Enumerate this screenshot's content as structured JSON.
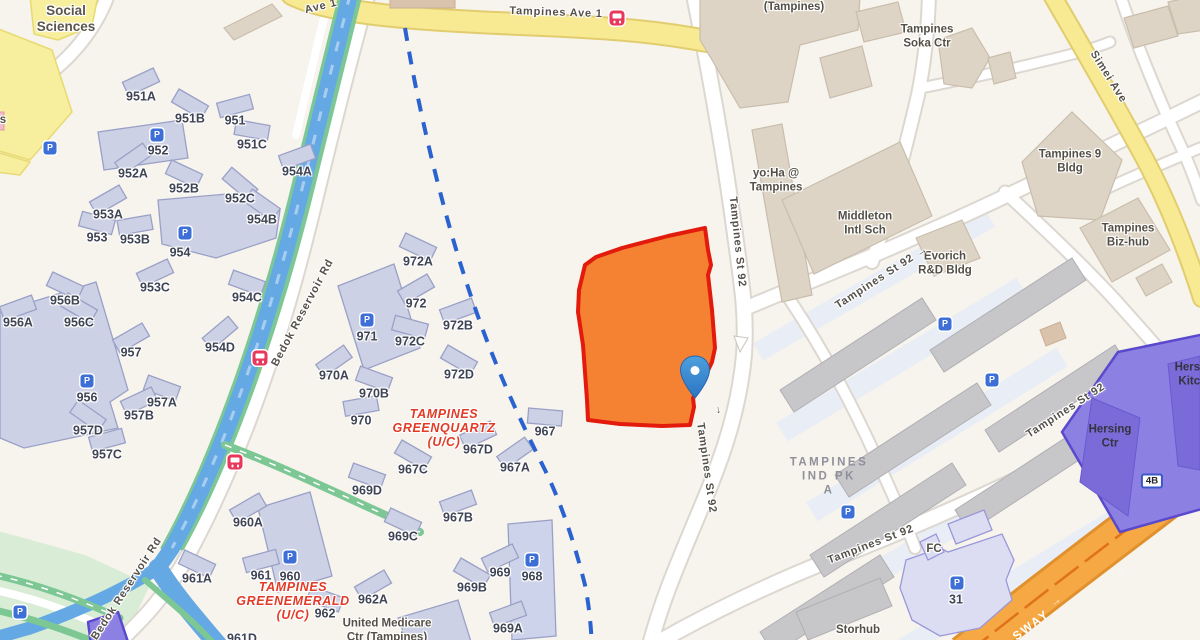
{
  "map": {
    "colors": {
      "land": "#f7f3ed",
      "parcel_fill": "#f47b28",
      "parcel_border": "#e21b0c",
      "pin_blue": "#3e8ecf",
      "canal_blue": "#64a9e4",
      "road_yellow": "#f8e993",
      "expressway_orange": "#f5a843",
      "purple_zone": "#8d80e3",
      "residential_building": "#cdd1e5",
      "boundary_dash_blue": "#2a63cf"
    },
    "labels": [
      {
        "t": "Social\nSciences",
        "x": 66,
        "y": 19,
        "c": "poilg"
      },
      {
        "t": "s",
        "x": 3,
        "y": 121,
        "c": "poi"
      },
      {
        "t": "Ave 1",
        "x": 321,
        "y": 7,
        "r": -14,
        "c": "road"
      },
      {
        "t": "Tampines Ave 1",
        "x": 556,
        "y": 13,
        "r": 2,
        "c": "road"
      },
      {
        "t": "(Tampines)",
        "x": 794,
        "y": 8,
        "c": "poi"
      },
      {
        "t": "Tampines\nSoka Ctr",
        "x": 927,
        "y": 37,
        "c": "poi"
      },
      {
        "t": "Simei Ave",
        "x": 1108,
        "y": 77,
        "r": 58,
        "c": "road"
      },
      {
        "t": "Tampines 9\nBldg",
        "x": 1070,
        "y": 162,
        "c": "poi"
      },
      {
        "t": "Tampines\nBiz-hub",
        "x": 1128,
        "y": 236,
        "c": "poi"
      },
      {
        "t": "yo:Ha @\nTampines",
        "x": 776,
        "y": 181,
        "c": "poi"
      },
      {
        "t": "Middleton\nIntl Sch",
        "x": 865,
        "y": 224,
        "c": "poi"
      },
      {
        "t": "Evorich\nR&D Bldg",
        "x": 945,
        "y": 264,
        "c": "poi"
      },
      {
        "t": "Tampines St 92",
        "x": 737,
        "y": 242,
        "r": 84,
        "c": "road"
      },
      {
        "t": "Tampines St 92",
        "x": 875,
        "y": 282,
        "r": -33,
        "c": "road"
      },
      {
        "t": "Tampines St 92",
        "x": 706,
        "y": 468,
        "r": 82,
        "c": "road"
      },
      {
        "t": "Tampines St 92",
        "x": 1066,
        "y": 411,
        "r": -33,
        "c": "road"
      },
      {
        "t": "Tampines St 92",
        "x": 871,
        "y": 545,
        "r": -21,
        "c": "road"
      },
      {
        "t": "Bedok Reservoir Rd",
        "x": 303,
        "y": 313,
        "r": -62,
        "c": "road"
      },
      {
        "t": "Bedok Reservoir Rd",
        "x": 127,
        "y": 589,
        "r": -57,
        "c": "road"
      },
      {
        "t": "SWAY",
        "x": 1031,
        "y": 625,
        "r": -37,
        "c": "expwy"
      },
      {
        "t": "TAMPINES\nGREENQUARTZ\n(U/C)",
        "x": 444,
        "y": 428,
        "c": "redarea"
      },
      {
        "t": "TAMPINES\nGREENEMERALD\n(U/C)",
        "x": 293,
        "y": 601,
        "c": "redarea"
      },
      {
        "t": "TAMPINES\nIND PK\nA",
        "x": 829,
        "y": 477,
        "c": "indarea"
      },
      {
        "t": "United Medicare\nCtr (Tampines)",
        "x": 387,
        "y": 631,
        "c": "poi"
      },
      {
        "t": "Storhub",
        "x": 858,
        "y": 631,
        "c": "poi"
      },
      {
        "t": "FC",
        "x": 934,
        "y": 550,
        "c": "poi"
      },
      {
        "t": "31",
        "x": 956,
        "y": 600,
        "c": "blk"
      },
      {
        "t": "Hersing\nKitche",
        "x": 1196,
        "y": 375,
        "c": "poidk"
      },
      {
        "t": "Hersing\nCtr",
        "x": 1110,
        "y": 437,
        "c": "poidk"
      },
      {
        "t": "4B",
        "x": 1152,
        "y": 481,
        "c": "badge"
      },
      {
        "t": "951A",
        "x": 141,
        "y": 97,
        "c": "blk",
        "b": -25
      },
      {
        "t": "951B",
        "x": 190,
        "y": 119,
        "c": "blk",
        "b": 30
      },
      {
        "t": "951",
        "x": 235,
        "y": 121,
        "c": "blk",
        "b": -15
      },
      {
        "t": "952",
        "x": 158,
        "y": 151,
        "c": "blk"
      },
      {
        "t": "951C",
        "x": 252,
        "y": 145,
        "c": "blk",
        "b": 10
      },
      {
        "t": "952A",
        "x": 133,
        "y": 174,
        "c": "blk",
        "b": -35
      },
      {
        "t": "952B",
        "x": 184,
        "y": 189,
        "c": "blk",
        "b": 25
      },
      {
        "t": "954A",
        "x": 297,
        "y": 172,
        "c": "blk",
        "b": -20
      },
      {
        "t": "952C",
        "x": 240,
        "y": 199,
        "c": "blk",
        "b": 40
      },
      {
        "t": "953A",
        "x": 108,
        "y": 215,
        "c": "blk",
        "b": -30
      },
      {
        "t": "953",
        "x": 97,
        "y": 238,
        "c": "blk",
        "b": 15
      },
      {
        "t": "953B",
        "x": 135,
        "y": 240,
        "c": "blk",
        "b": -10
      },
      {
        "t": "954B",
        "x": 262,
        "y": 220,
        "c": "blk",
        "b": 35
      },
      {
        "t": "954",
        "x": 180,
        "y": 253,
        "c": "blk"
      },
      {
        "t": "953C",
        "x": 155,
        "y": 288,
        "c": "blk",
        "b": -25
      },
      {
        "t": "954C",
        "x": 247,
        "y": 298,
        "c": "blk",
        "b": 20
      },
      {
        "t": "954D",
        "x": 220,
        "y": 348,
        "c": "blk",
        "b": -40
      },
      {
        "t": "956B",
        "x": 65,
        "y": 301,
        "c": "blk",
        "b": 25
      },
      {
        "t": "956A",
        "x": 18,
        "y": 323,
        "c": "blk",
        "b": -20
      },
      {
        "t": "956C",
        "x": 79,
        "y": 323,
        "c": "blk",
        "b": 30
      },
      {
        "t": "957",
        "x": 131,
        "y": 353,
        "c": "blk",
        "b": -30
      },
      {
        "t": "956",
        "x": 87,
        "y": 398,
        "c": "blk"
      },
      {
        "t": "957A",
        "x": 162,
        "y": 403,
        "c": "blk",
        "b": 20
      },
      {
        "t": "957B",
        "x": 139,
        "y": 416,
        "c": "blk",
        "b": -25
      },
      {
        "t": "957D",
        "x": 88,
        "y": 431,
        "c": "blk",
        "b": 35
      },
      {
        "t": "957C",
        "x": 107,
        "y": 455,
        "c": "blk",
        "b": -15
      },
      {
        "t": "972A",
        "x": 418,
        "y": 262,
        "c": "blk",
        "b": 25
      },
      {
        "t": "972",
        "x": 416,
        "y": 304,
        "c": "blk",
        "b": -30
      },
      {
        "t": "971",
        "x": 367,
        "y": 337,
        "c": "blk"
      },
      {
        "t": "972C",
        "x": 410,
        "y": 342,
        "c": "blk",
        "b": 15
      },
      {
        "t": "972B",
        "x": 458,
        "y": 326,
        "c": "blk",
        "b": -20
      },
      {
        "t": "972D",
        "x": 459,
        "y": 375,
        "c": "blk",
        "b": 30
      },
      {
        "t": "970A",
        "x": 334,
        "y": 376,
        "c": "blk",
        "b": -35
      },
      {
        "t": "970B",
        "x": 374,
        "y": 394,
        "c": "blk",
        "b": 20
      },
      {
        "t": "970",
        "x": 361,
        "y": 421,
        "c": "blk",
        "b": -10
      },
      {
        "t": "967",
        "x": 545,
        "y": 432,
        "c": "blk",
        "b": 5
      },
      {
        "t": "967D",
        "x": 478,
        "y": 450,
        "c": "blk",
        "b": -25
      },
      {
        "t": "967C",
        "x": 413,
        "y": 470,
        "c": "blk",
        "b": 30
      },
      {
        "t": "967A",
        "x": 515,
        "y": 468,
        "c": "blk",
        "b": -35
      },
      {
        "t": "969D",
        "x": 367,
        "y": 491,
        "c": "blk",
        "b": 20
      },
      {
        "t": "967B",
        "x": 458,
        "y": 518,
        "c": "blk",
        "b": -20
      },
      {
        "t": "969C",
        "x": 403,
        "y": 537,
        "c": "blk",
        "b": 25
      },
      {
        "t": "960A",
        "x": 248,
        "y": 523,
        "c": "blk",
        "b": -30
      },
      {
        "t": "961A",
        "x": 197,
        "y": 579,
        "c": "blk",
        "b": 25
      },
      {
        "t": "961",
        "x": 261,
        "y": 576,
        "c": "blk",
        "b": -15
      },
      {
        "t": "960",
        "x": 290,
        "y": 577,
        "c": "blk"
      },
      {
        "t": "962A",
        "x": 373,
        "y": 600,
        "c": "blk",
        "b": -30
      },
      {
        "t": "962",
        "x": 325,
        "y": 614,
        "c": "blk",
        "b": 20
      },
      {
        "t": "969",
        "x": 500,
        "y": 573,
        "c": "blk",
        "b": -25
      },
      {
        "t": "969B",
        "x": 472,
        "y": 588,
        "c": "blk",
        "b": 30
      },
      {
        "t": "968",
        "x": 532,
        "y": 577,
        "c": "blk"
      },
      {
        "t": "969A",
        "x": 508,
        "y": 629,
        "c": "blk",
        "b": -20
      },
      {
        "t": "961D",
        "x": 242,
        "y": 639,
        "c": "blk"
      }
    ],
    "icons": {
      "parking_glyph": "P",
      "parking_positions": [
        [
          50,
          148
        ],
        [
          157,
          135
        ],
        [
          185,
          233
        ],
        [
          87,
          381
        ],
        [
          367,
          320
        ],
        [
          290,
          557
        ],
        [
          532,
          560
        ],
        [
          20,
          612
        ],
        [
          945,
          324
        ],
        [
          992,
          380
        ],
        [
          848,
          512
        ],
        [
          957,
          583
        ]
      ],
      "bus_positions": [
        [
          617,
          18
        ],
        [
          260,
          358
        ],
        [
          235,
          462
        ]
      ],
      "arrows": [
        {
          "g": "→",
          "x": 922,
          "y": 252,
          "r": -33,
          "c": "rdarrow"
        },
        {
          "g": "→",
          "x": 719,
          "y": 410,
          "r": 82,
          "c": "rdarrow"
        },
        {
          "g": "→",
          "x": 1056,
          "y": 602,
          "r": -37,
          "c": "exparrow"
        },
        {
          "g": "→",
          "x": 1122,
          "y": 573,
          "r": 143,
          "c": "exparrow"
        }
      ]
    },
    "pin": {
      "x": 695,
      "y": 372
    }
  }
}
